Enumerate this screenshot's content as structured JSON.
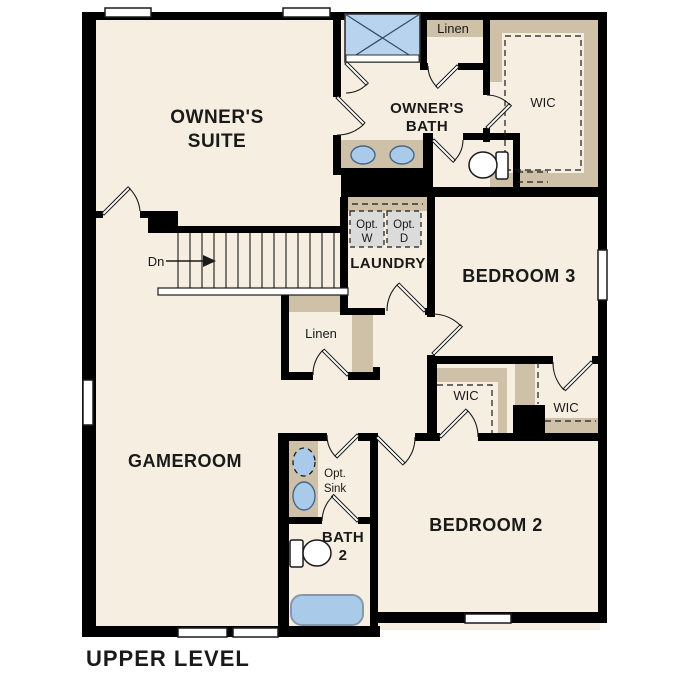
{
  "plan": {
    "title": "UPPER LEVEL",
    "stairs": {
      "direction_label": "Dn"
    },
    "rooms": {
      "owners_suite": {
        "line1": "OWNER'S",
        "line2": "SUITE"
      },
      "owners_bath": {
        "line1": "OWNER'S",
        "line2": "BATH"
      },
      "linen_upper": {
        "label": "Linen"
      },
      "wic_owners": {
        "label": "WIC"
      },
      "laundry": {
        "label": "LAUNDRY"
      },
      "opt_washer": {
        "line1": "Opt.",
        "line2": "W"
      },
      "opt_dryer": {
        "line1": "Opt.",
        "line2": "D"
      },
      "bedroom3": {
        "label": "BEDROOM 3"
      },
      "linen_hall": {
        "label": "Linen"
      },
      "wic_bedroom3": {
        "label": "WIC"
      },
      "wic_bedroom2": {
        "label": "WIC"
      },
      "gameroom": {
        "label": "GAMEROOM"
      },
      "opt_sink": {
        "line1": "Opt.",
        "line2": "Sink"
      },
      "bath2": {
        "line1": "BATH",
        "line2": "2"
      },
      "bedroom2": {
        "label": "BEDROOM 2"
      }
    },
    "colors": {
      "background": "#ffffff",
      "floor": "#f6eee0",
      "wall": "#000000",
      "cabinetry": "#cfc1a8",
      "fixture_blue": "#a9cbe9",
      "shower_blue": "#b7d3ed",
      "appliance_gray": "#dbdbdb"
    }
  }
}
